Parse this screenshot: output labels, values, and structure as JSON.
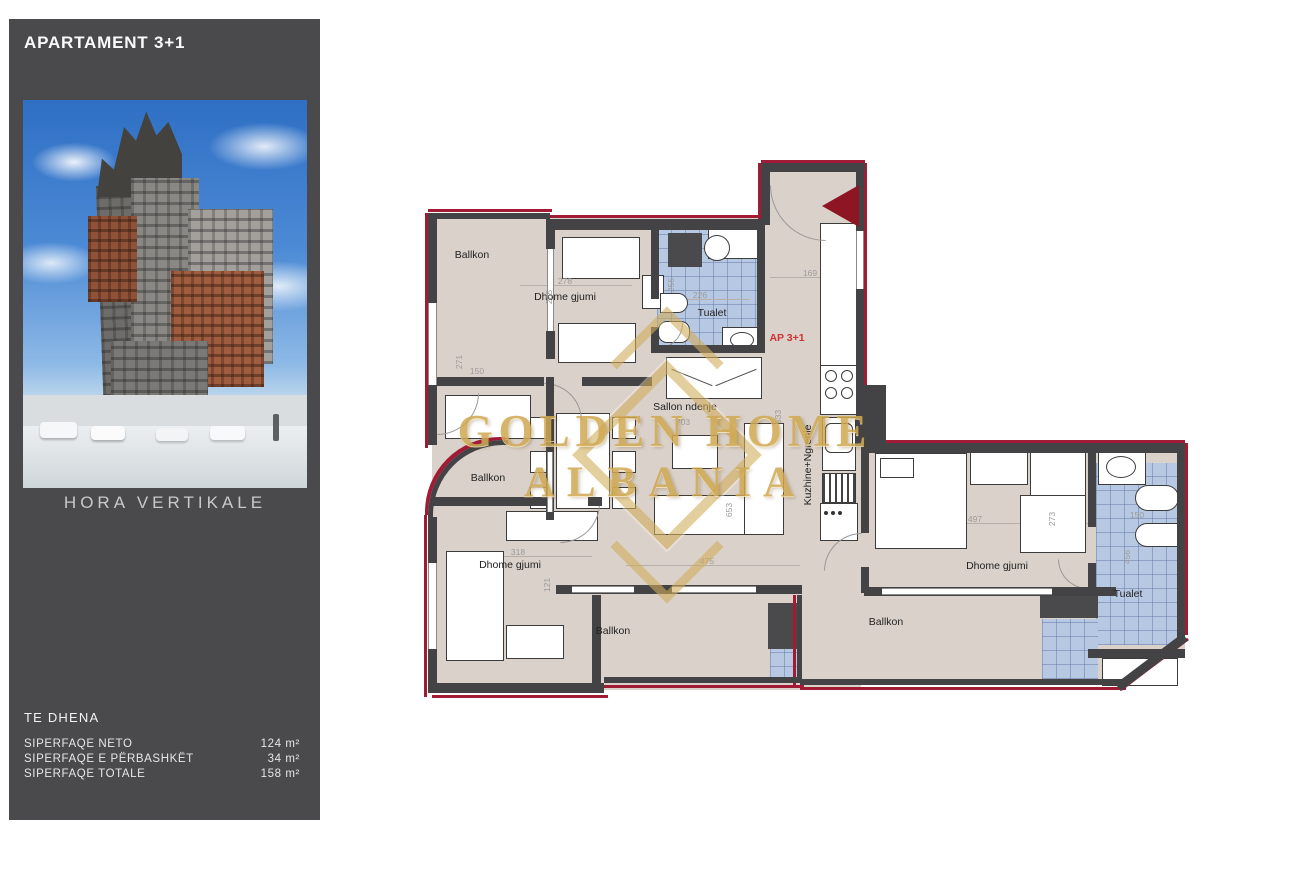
{
  "sidebar": {
    "title": "APARTAMENT 3+1",
    "photo_caption": "HORA VERTIKALE",
    "data_heading": "TE DHENA",
    "rows": [
      {
        "label": "SIPERFAQE NETO",
        "value": "124 m²"
      },
      {
        "label": "SIPERFAQE E PËRBASHKËT",
        "value": "34 m²"
      },
      {
        "label": "SIPERFAQE TOTALE",
        "value": "158 m²"
      }
    ]
  },
  "plan": {
    "apartment_tag": "AP 3+1",
    "watermark": {
      "line1": "GOLDEN HOME",
      "line2": "ALBANIA"
    },
    "rooms": [
      {
        "label": "Ballkon"
      },
      {
        "label": "Dhome gjumi"
      },
      {
        "label": "Tualet"
      },
      {
        "label": "Sallon ndenje"
      },
      {
        "label": "Kuzhine+Ngrenie"
      },
      {
        "label": "Ballkon"
      },
      {
        "label": "Dhome gjumi"
      },
      {
        "label": "Ballkon"
      },
      {
        "label": "Ballkon"
      },
      {
        "label": "Dhome gjumi"
      },
      {
        "label": "Tualet"
      }
    ],
    "dims": [
      "278",
      "285",
      "226",
      "255",
      "169",
      "271",
      "150",
      "318",
      "121",
      "703",
      "653",
      "475",
      "533",
      "497",
      "273",
      "150",
      "456"
    ]
  },
  "colors": {
    "sidebar_bg": "#4a4a4d",
    "boundary_red": "#a11b35",
    "wall_gray": "#434345",
    "floor_beige": "#dad1ca",
    "tile_blue": "#b7c8e2",
    "watermark_gold": "#cfa952",
    "tag_red": "#cc3333"
  }
}
